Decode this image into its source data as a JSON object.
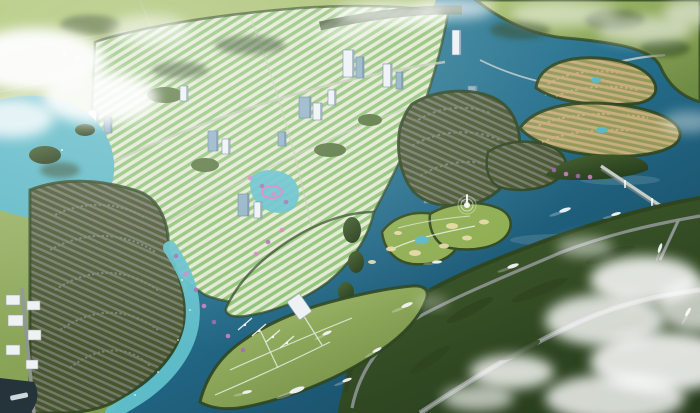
{
  "scene": {
    "type": "aerial-3d-render",
    "subject": "riverside master-planned township with winding river, villa islands, golf course and marina",
    "fountain": true,
    "boat_count": 12
  },
  "colors": {
    "land_g0": "#a8c06e",
    "land_g1": "#6f8c44",
    "field_light": "#b3ca78",
    "forest": "#2e4520",
    "land_mid": "#5d7c3a",
    "dark_g0": "#46622f",
    "dark_g1": "#263c1c",
    "water_g0": "#3a8ba1",
    "water_g1": "#246e8c",
    "water_g2": "#143f58",
    "turquoise": "#62c0cb",
    "lake_turquoise": "#5cb8c6",
    "city_ground": "#e2e9d2",
    "roof_green": "#8fc276",
    "roof_dark": "#717a68",
    "dark_villa_bg": "#49552f",
    "beige_bg": "#93995a",
    "roof_beige": "#c9ae7d",
    "golf_green": "#8fae52",
    "sand": "#e6d9a8",
    "road_grey": "#8e9593",
    "road_light": "#c6cdc9",
    "path_white": "#e9efe6",
    "building_white": "#eef2f4",
    "building_blue": "#8fb0c6",
    "building_shadow": "#64809a",
    "cloud": "#ffffff",
    "accent_purple": "#a868b4",
    "accent_pink": "#d981c2",
    "boat_white": "#f2f6f7",
    "park_green": "#57743c",
    "port_dark": "#25333a",
    "row_arc": "#7b8574"
  },
  "towers": [
    {
      "x": 343,
      "y": 50,
      "w": 11,
      "h": 27,
      "c": "w"
    },
    {
      "x": 356,
      "y": 57,
      "w": 8,
      "h": 21,
      "c": "b"
    },
    {
      "x": 383,
      "y": 64,
      "w": 9,
      "h": 23,
      "c": "w"
    },
    {
      "x": 396,
      "y": 72,
      "w": 7,
      "h": 17,
      "c": "b"
    },
    {
      "x": 452,
      "y": 30,
      "w": 9,
      "h": 25,
      "c": "w"
    },
    {
      "x": 468,
      "y": 86,
      "w": 9,
      "h": 18,
      "c": "b"
    },
    {
      "x": 299,
      "y": 97,
      "w": 12,
      "h": 21,
      "c": "b"
    },
    {
      "x": 313,
      "y": 103,
      "w": 9,
      "h": 17,
      "c": "w"
    },
    {
      "x": 328,
      "y": 90,
      "w": 8,
      "h": 15,
      "c": "w"
    },
    {
      "x": 88,
      "y": 110,
      "w": 10,
      "h": 21,
      "c": "w"
    },
    {
      "x": 104,
      "y": 117,
      "w": 8,
      "h": 16,
      "c": "b"
    },
    {
      "x": 48,
      "y": 126,
      "w": 10,
      "h": 25,
      "c": "w"
    },
    {
      "x": 208,
      "y": 131,
      "w": 10,
      "h": 20,
      "c": "b"
    },
    {
      "x": 222,
      "y": 139,
      "w": 8,
      "h": 15,
      "c": "w"
    },
    {
      "x": 238,
      "y": 194,
      "w": 11,
      "h": 22,
      "c": "b"
    },
    {
      "x": 254,
      "y": 202,
      "w": 8,
      "h": 16,
      "c": "w"
    },
    {
      "x": 424,
      "y": 183,
      "w": 10,
      "h": 20,
      "c": "b"
    },
    {
      "x": 439,
      "y": 191,
      "w": 8,
      "h": 15,
      "c": "w"
    },
    {
      "x": 180,
      "y": 86,
      "w": 8,
      "h": 15,
      "c": "w"
    },
    {
      "x": 278,
      "y": 132,
      "w": 8,
      "h": 14,
      "c": "b"
    }
  ],
  "boats": [
    {
      "x": 565,
      "y": 210,
      "a": -18,
      "l": 6
    },
    {
      "x": 616,
      "y": 214,
      "a": -15,
      "l": 5
    },
    {
      "x": 513,
      "y": 266,
      "a": -18,
      "l": 6
    },
    {
      "x": 437,
      "y": 262,
      "a": -5,
      "l": 5
    },
    {
      "x": 407,
      "y": 305,
      "a": -22,
      "l": 6
    },
    {
      "x": 377,
      "y": 350,
      "a": -28,
      "l": 5
    },
    {
      "x": 327,
      "y": 333,
      "a": -24,
      "l": 5
    },
    {
      "x": 297,
      "y": 390,
      "a": -20,
      "l": 8
    },
    {
      "x": 347,
      "y": 380,
      "a": -20,
      "l": 5
    },
    {
      "x": 247,
      "y": 392,
      "a": -12,
      "l": 5
    },
    {
      "x": 660,
      "y": 248,
      "a": -70,
      "l": 5
    },
    {
      "x": 688,
      "y": 312,
      "a": -60,
      "l": 5
    }
  ],
  "clouds": [
    {
      "x": 35,
      "y": 60,
      "rx": 70,
      "ry": 32,
      "o": 0.95
    },
    {
      "x": 100,
      "y": 98,
      "rx": 58,
      "ry": 26,
      "o": 0.9
    },
    {
      "x": 12,
      "y": 118,
      "rx": 42,
      "ry": 20,
      "o": 0.8
    },
    {
      "x": 150,
      "y": 30,
      "rx": 40,
      "ry": 15,
      "o": 0.55
    },
    {
      "x": 390,
      "y": 14,
      "rx": 55,
      "ry": 13,
      "o": 0.7
    },
    {
      "x": 455,
      "y": 8,
      "rx": 40,
      "ry": 11,
      "o": 0.65
    },
    {
      "x": 345,
      "y": 32,
      "rx": 30,
      "ry": 9,
      "o": 0.45
    },
    {
      "x": 565,
      "y": 14,
      "rx": 55,
      "ry": 13,
      "o": 0.5
    },
    {
      "x": 645,
      "y": 30,
      "rx": 48,
      "ry": 14,
      "o": 0.55
    },
    {
      "x": 698,
      "y": 12,
      "rx": 35,
      "ry": 14,
      "o": 0.55
    },
    {
      "x": 688,
      "y": 122,
      "rx": 26,
      "ry": 11,
      "o": 0.4
    },
    {
      "x": 645,
      "y": 280,
      "rx": 55,
      "ry": 24,
      "o": 0.85
    },
    {
      "x": 605,
      "y": 320,
      "rx": 60,
      "ry": 26,
      "o": 0.8
    },
    {
      "x": 662,
      "y": 362,
      "rx": 72,
      "ry": 30,
      "o": 0.85
    },
    {
      "x": 615,
      "y": 398,
      "rx": 70,
      "ry": 24,
      "o": 0.8
    },
    {
      "x": 698,
      "y": 306,
      "rx": 40,
      "ry": 26,
      "o": 0.7
    },
    {
      "x": 512,
      "y": 372,
      "rx": 42,
      "ry": 17,
      "o": 0.8
    },
    {
      "x": 478,
      "y": 398,
      "rx": 36,
      "ry": 13,
      "o": 0.65
    },
    {
      "x": 585,
      "y": 247,
      "rx": 28,
      "ry": 10,
      "o": 0.5
    },
    {
      "x": 432,
      "y": 302,
      "rx": 16,
      "ry": 6,
      "o": 0.35
    }
  ],
  "bunkers": [
    {
      "x": 452,
      "y": 226,
      "rx": 6,
      "ry": 3
    },
    {
      "x": 467,
      "y": 238,
      "rx": 5,
      "ry": 2.5
    },
    {
      "x": 444,
      "y": 246,
      "rx": 5,
      "ry": 2.5
    },
    {
      "x": 415,
      "y": 253,
      "rx": 6,
      "ry": 3
    },
    {
      "x": 391,
      "y": 249,
      "rx": 5,
      "ry": 2.5
    },
    {
      "x": 398,
      "y": 233,
      "rx": 4,
      "ry": 2
    },
    {
      "x": 484,
      "y": 222,
      "rx": 5,
      "ry": 2.5
    },
    {
      "x": 372,
      "y": 262,
      "rx": 4,
      "ry": 2
    },
    {
      "x": 595,
      "y": 282,
      "rx": 7,
      "ry": 3
    },
    {
      "x": 575,
      "y": 292,
      "rx": 5,
      "ry": 2.5
    }
  ],
  "accents": [
    {
      "x": 176,
      "y": 256
    },
    {
      "x": 186,
      "y": 274
    },
    {
      "x": 196,
      "y": 290
    },
    {
      "x": 204,
      "y": 306
    },
    {
      "x": 214,
      "y": 322
    },
    {
      "x": 228,
      "y": 336
    },
    {
      "x": 243,
      "y": 350
    },
    {
      "x": 256,
      "y": 254
    },
    {
      "x": 268,
      "y": 242
    },
    {
      "x": 282,
      "y": 230
    },
    {
      "x": 554,
      "y": 170
    },
    {
      "x": 566,
      "y": 174
    },
    {
      "x": 578,
      "y": 176
    },
    {
      "x": 590,
      "y": 177
    },
    {
      "x": 262,
      "y": 186
    },
    {
      "x": 274,
      "y": 194
    },
    {
      "x": 286,
      "y": 202
    },
    {
      "x": 250,
      "y": 178
    }
  ]
}
